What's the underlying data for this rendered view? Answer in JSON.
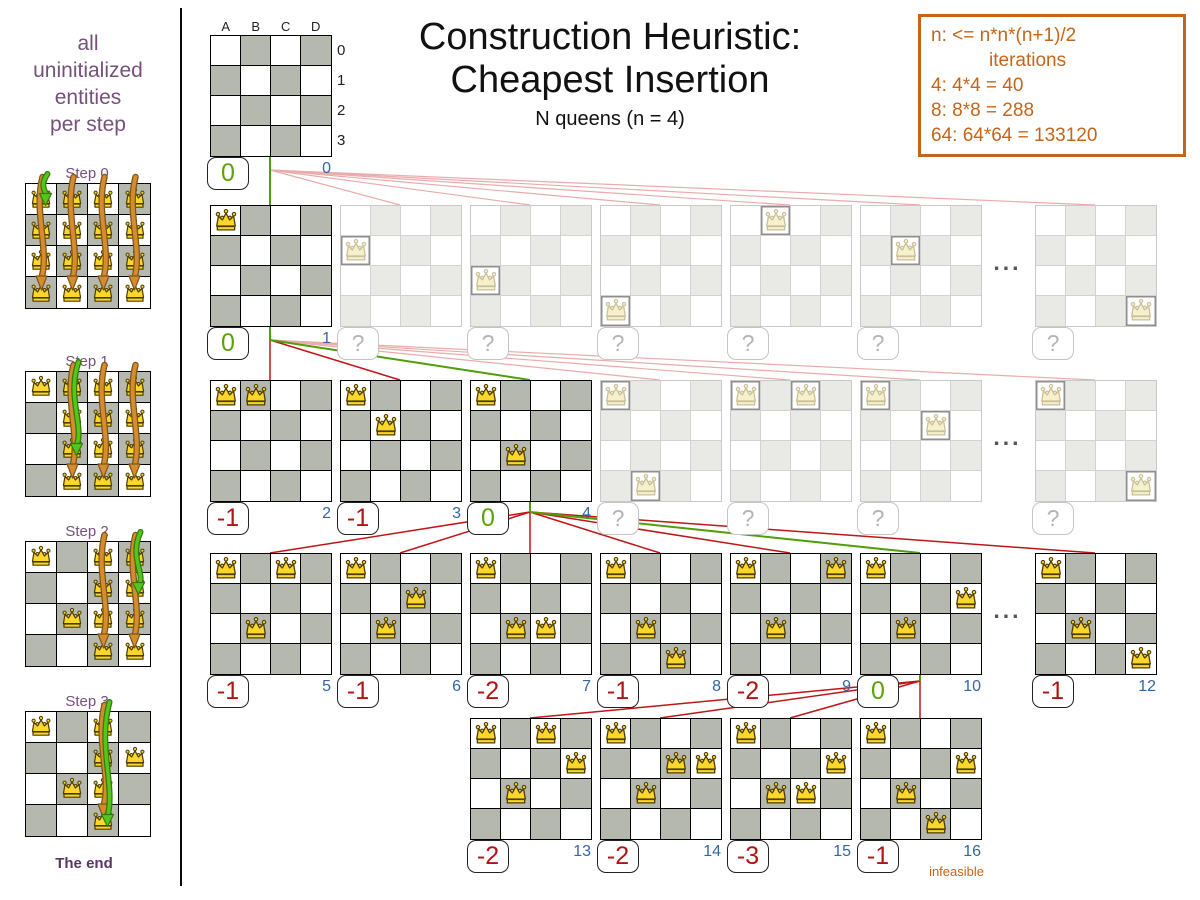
{
  "header": {
    "title_line1": "Construction Heuristic:",
    "title_line2": "Cheapest Insertion",
    "subtitle": "N queens (n = 4)"
  },
  "info_box": {
    "line1": "n: <= n*n*(n+1)/2",
    "line2": "iterations",
    "line3": "4: 4*4 = 40",
    "line4": "8: 8*8 = 288",
    "line5": "64: 64*64 = 133120"
  },
  "sidebar": {
    "caption_line1": "all",
    "caption_line2": "uninitialized",
    "caption_line3": "entities",
    "caption_line4": "per step",
    "end_label": "The end",
    "steps": [
      {
        "label": "Step 0",
        "fixed": [],
        "candidate_cols": [
          "A",
          "B",
          "C",
          "D"
        ],
        "green_target": "A0"
      },
      {
        "label": "Step 1",
        "fixed": [
          "A0"
        ],
        "candidate_cols": [
          "B",
          "C",
          "D"
        ],
        "green_target": "B2"
      },
      {
        "label": "Step 2",
        "fixed": [
          "A0",
          "B2"
        ],
        "candidate_cols": [
          "C",
          "D"
        ],
        "green_target": "D1"
      },
      {
        "label": "Step 3",
        "fixed": [
          "A0",
          "B2",
          "D1"
        ],
        "candidate_cols": [
          "C"
        ],
        "green_target": "C3"
      }
    ]
  },
  "board_labels": {
    "cols": [
      "A",
      "B",
      "C",
      "D"
    ],
    "rows": [
      "0",
      "1",
      "2",
      "3"
    ]
  },
  "ellipsis": "...",
  "tree": {
    "root": {
      "col": 0,
      "queens": [],
      "score": "0",
      "index": "0",
      "state": "selected"
    },
    "rows": [
      {
        "parent": "root",
        "ellipsis_at": 6,
        "boards": [
          {
            "col": 0,
            "queens": [
              "A0"
            ],
            "score": "0",
            "index": "1",
            "state": "selected"
          },
          {
            "col": 1,
            "queens": [
              "A1"
            ],
            "score": "?",
            "state": "faded"
          },
          {
            "col": 2,
            "queens": [
              "A2"
            ],
            "score": "?",
            "state": "faded"
          },
          {
            "col": 3,
            "queens": [
              "A3"
            ],
            "score": "?",
            "state": "faded"
          },
          {
            "col": 4,
            "queens": [
              "B0"
            ],
            "score": "?",
            "state": "faded"
          },
          {
            "col": 5,
            "queens": [
              "B1"
            ],
            "score": "?",
            "state": "faded"
          },
          {
            "col": 6,
            "queens": [
              "D3"
            ],
            "score": "?",
            "state": "faded"
          }
        ]
      },
      {
        "parent_col": 0,
        "ellipsis_at": 6,
        "boards": [
          {
            "col": 0,
            "queens": [
              "A0",
              "B0"
            ],
            "score": "-1",
            "index": "2",
            "state": "evaluated"
          },
          {
            "col": 1,
            "queens": [
              "A0",
              "B1"
            ],
            "score": "-1",
            "index": "3",
            "state": "evaluated"
          },
          {
            "col": 2,
            "queens": [
              "A0",
              "B2"
            ],
            "score": "0",
            "index": "4",
            "state": "selected"
          },
          {
            "col": 3,
            "queens": [
              "A0",
              "B3"
            ],
            "score": "?",
            "state": "faded"
          },
          {
            "col": 4,
            "queens": [
              "A0",
              "C0"
            ],
            "score": "?",
            "state": "faded"
          },
          {
            "col": 5,
            "queens": [
              "A0",
              "C1"
            ],
            "score": "?",
            "state": "faded"
          },
          {
            "col": 6,
            "queens": [
              "A0",
              "D3"
            ],
            "score": "?",
            "state": "faded"
          }
        ]
      },
      {
        "parent_col": 2,
        "ellipsis_at": 6,
        "boards": [
          {
            "col": 0,
            "queens": [
              "A0",
              "B2",
              "C0"
            ],
            "score": "-1",
            "index": "5",
            "state": "evaluated"
          },
          {
            "col": 1,
            "queens": [
              "A0",
              "B2",
              "C1"
            ],
            "score": "-1",
            "index": "6",
            "state": "evaluated"
          },
          {
            "col": 2,
            "queens": [
              "A0",
              "B2",
              "C2"
            ],
            "score": "-2",
            "index": "7",
            "state": "evaluated"
          },
          {
            "col": 3,
            "queens": [
              "A0",
              "B2",
              "C3"
            ],
            "score": "-1",
            "index": "8",
            "state": "evaluated"
          },
          {
            "col": 4,
            "queens": [
              "A0",
              "B2",
              "D0"
            ],
            "score": "-2",
            "index": "9",
            "state": "evaluated"
          },
          {
            "col": 5,
            "queens": [
              "A0",
              "B2",
              "D1"
            ],
            "score": "0",
            "index": "10",
            "state": "selected"
          },
          {
            "col": 6,
            "queens": [
              "A0",
              "B2",
              "D3"
            ],
            "score": "-1",
            "index": "12",
            "state": "evaluated"
          }
        ]
      },
      {
        "parent_col": 5,
        "boards": [
          {
            "col": 2,
            "queens": [
              "A0",
              "B2",
              "C0",
              "D1"
            ],
            "score": "-2",
            "index": "13",
            "state": "evaluated"
          },
          {
            "col": 3,
            "queens": [
              "A0",
              "B2",
              "C1",
              "D1"
            ],
            "score": "-2",
            "index": "14",
            "state": "evaluated"
          },
          {
            "col": 4,
            "queens": [
              "A0",
              "B2",
              "C2",
              "D1"
            ],
            "score": "-3",
            "index": "15",
            "state": "evaluated"
          },
          {
            "col": 5,
            "queens": [
              "A0",
              "B2",
              "C3",
              "D1"
            ],
            "score": "-1",
            "index": "16",
            "state": "evaluated",
            "note": "infeasible"
          }
        ]
      }
    ]
  },
  "colors": {
    "accent_orange": "#c4651a",
    "infeasible_orange": "#cf6212",
    "purple": "#75507b",
    "end_purple": "#5c3566",
    "score_green": "#5ba30a",
    "score_red": "#b11414",
    "index_blue": "#3465a4",
    "line_green": "#4e9e06",
    "line_red": "#bf1616",
    "line_pink": "#eaabab",
    "board_gray": "#b5b8af"
  }
}
